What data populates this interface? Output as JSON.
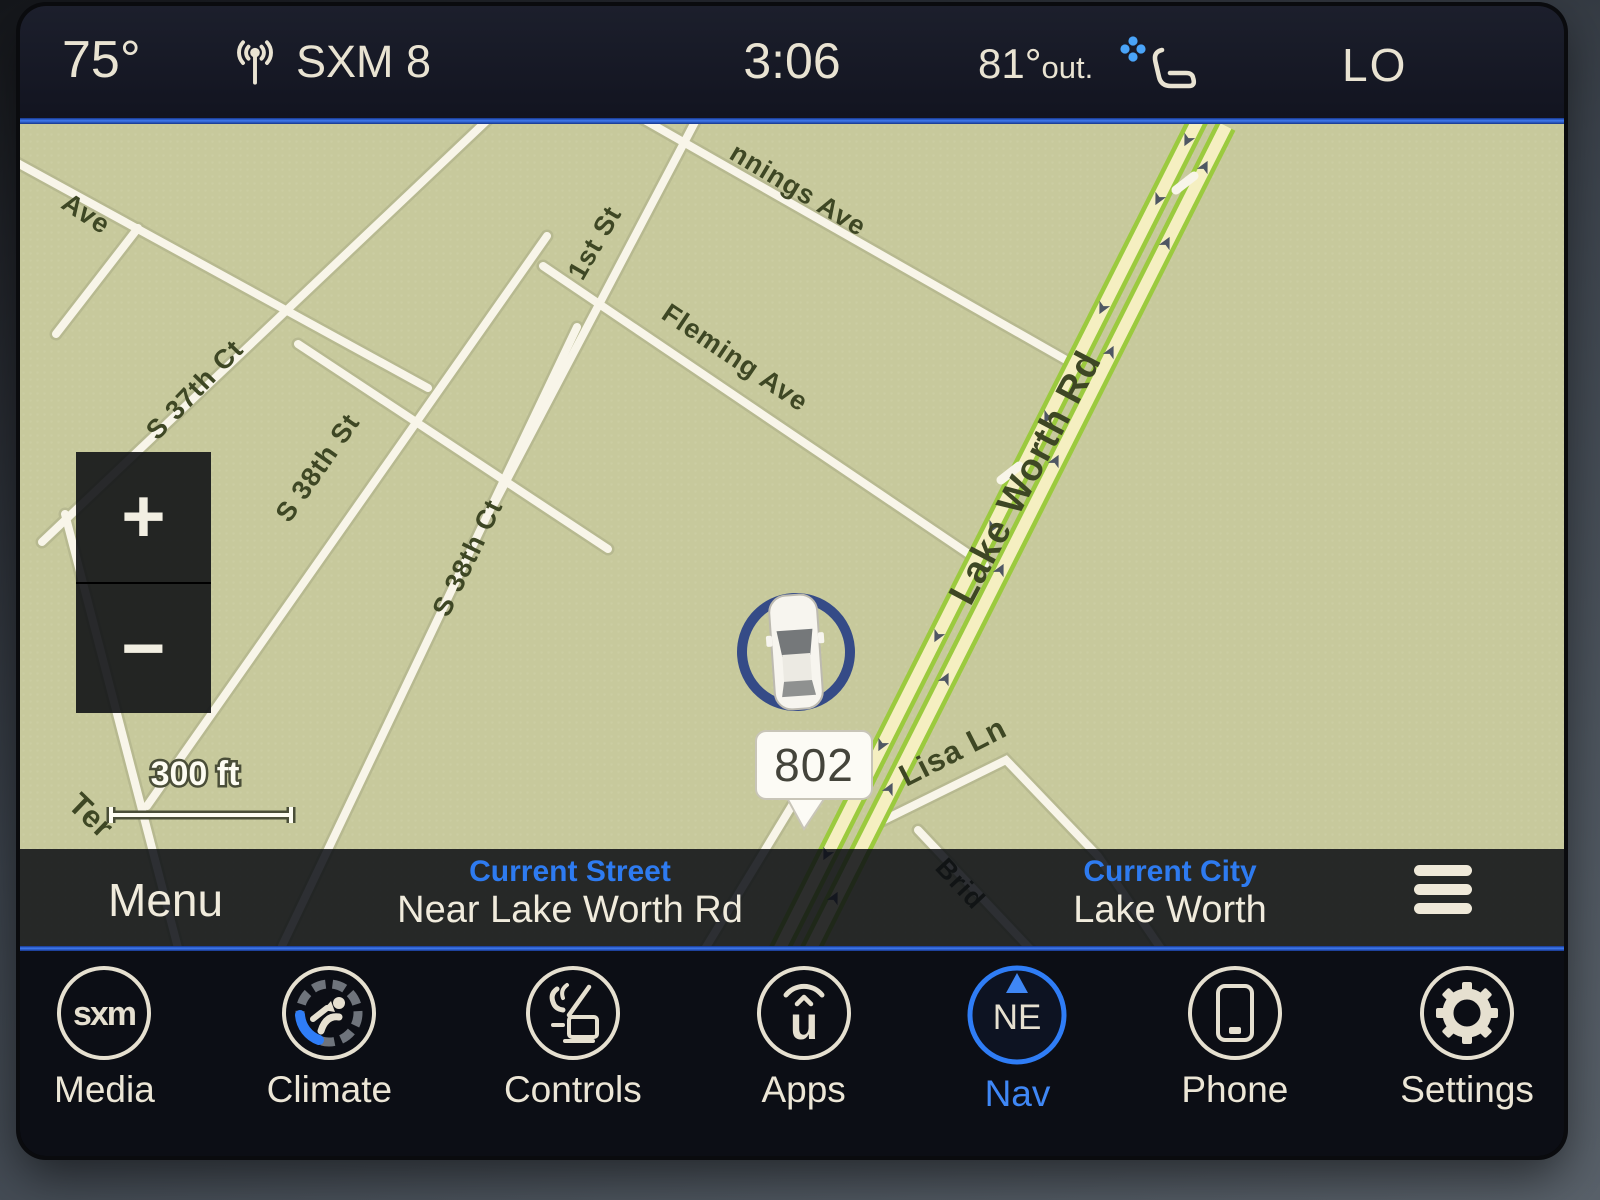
{
  "status_bar": {
    "cabin_temp": "75°",
    "radio_station": "SXM 8",
    "clock": "3:06",
    "outside_temp": "81°",
    "outside_suffix": "out.",
    "fan_speed": "LO"
  },
  "map": {
    "street_labels": [
      {
        "text": "Ave"
      },
      {
        "text": "nnings Ave"
      },
      {
        "text": "1st St"
      },
      {
        "text": "Fleming Ave"
      },
      {
        "text": "S 37th Ct"
      },
      {
        "text": "S 38th St"
      },
      {
        "text": "S 38th Ct"
      },
      {
        "text": "Lake Worth Rd"
      },
      {
        "text": "Lisa Ln"
      },
      {
        "text": "Brid"
      },
      {
        "text": "Ter"
      }
    ],
    "route_shield": "802",
    "scale_label": "300 ft",
    "zoom_in": "+",
    "zoom_out": "−"
  },
  "info_bar": {
    "menu": "Menu",
    "current_street_label": "Current Street",
    "current_street": "Near Lake Worth Rd",
    "current_city_label": "Current City",
    "current_city": "Lake Worth"
  },
  "app_bar": {
    "compass_heading": "NE",
    "media_badge": "sxm",
    "apps_glyph": "u",
    "items": [
      {
        "label": "Media"
      },
      {
        "label": "Climate"
      },
      {
        "label": "Controls"
      },
      {
        "label": "Apps"
      },
      {
        "label": "Nav"
      },
      {
        "label": "Phone"
      },
      {
        "label": "Settings"
      }
    ]
  },
  "colors": {
    "accent_blue": "#2f7df6",
    "divider_blue": "#3f7af0",
    "map_background": "#c7c99c",
    "road_casing_green": "#9bca3e",
    "street_label_green": "#3e4724"
  }
}
